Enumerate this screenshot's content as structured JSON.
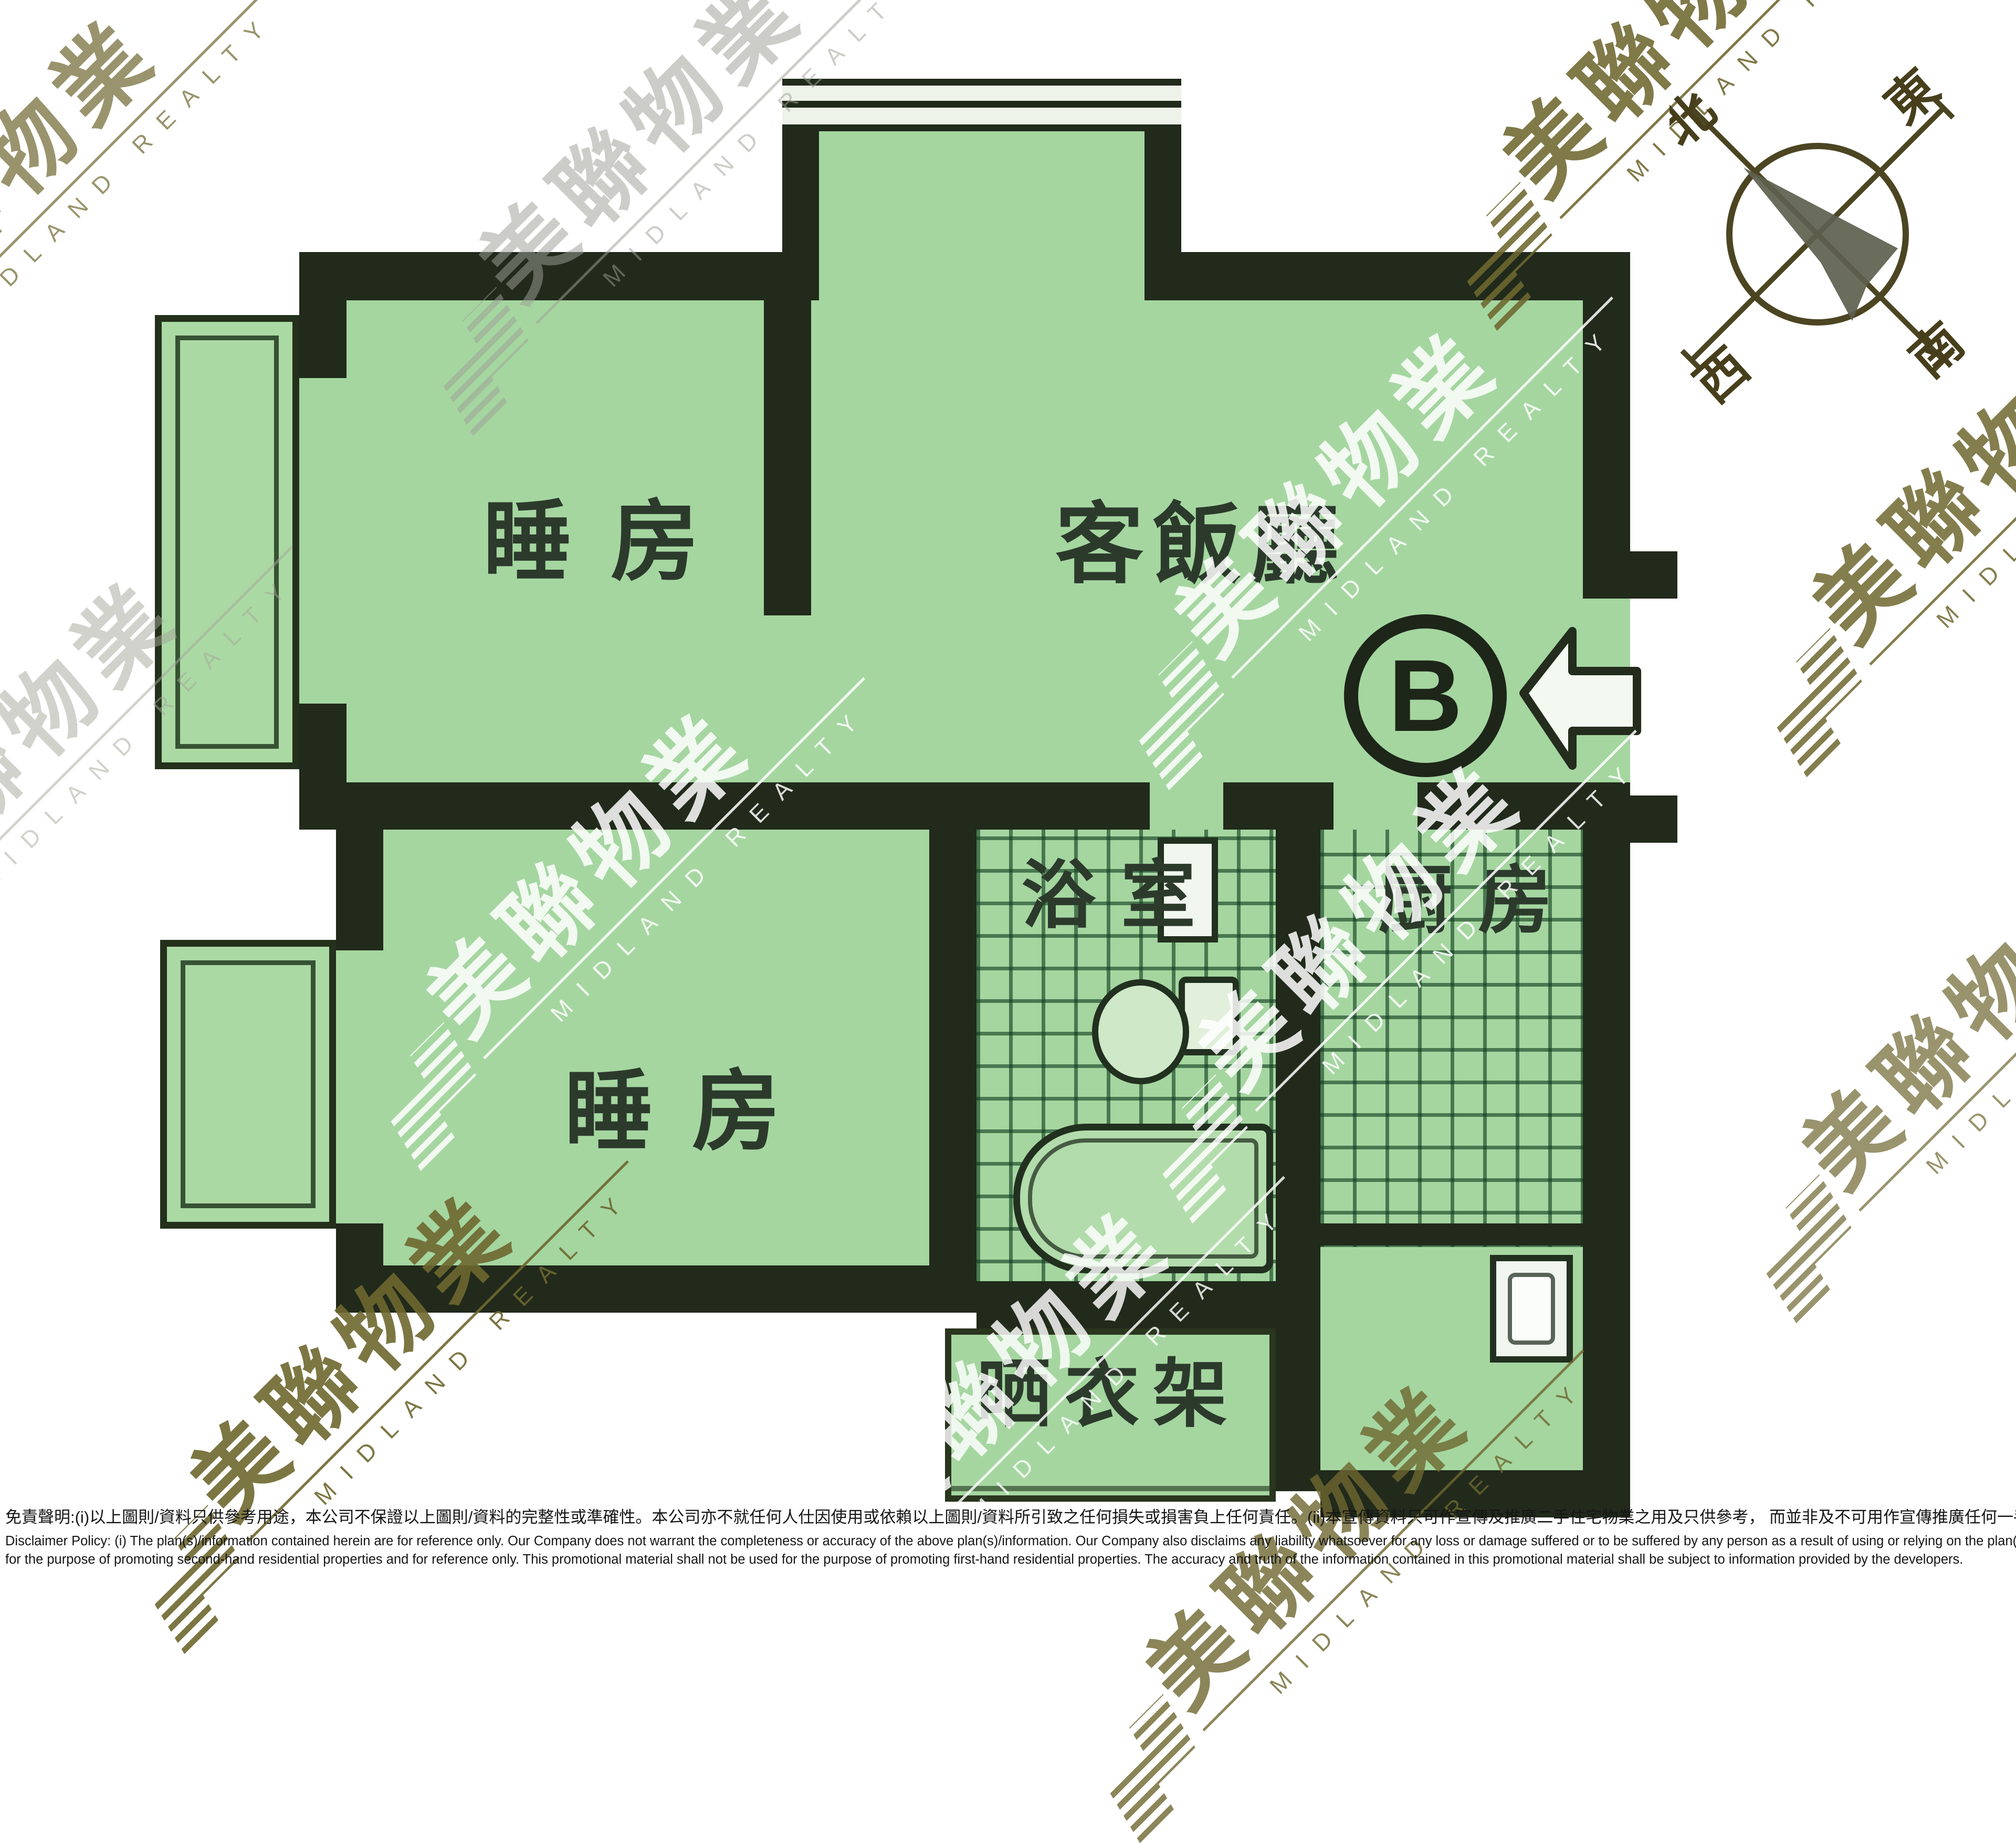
{
  "plan": {
    "unit_label": "B",
    "rooms": {
      "bedroom1": "睡房",
      "living_dining": "客飯廳",
      "bedroom2": "睡房",
      "bathroom": "浴室",
      "kitchen": "厨房",
      "drying_rack": "晒衣架"
    }
  },
  "compass": {
    "north": "北",
    "east": "東",
    "west": "西",
    "south": "南"
  },
  "watermark": {
    "cjk": "美聯物業",
    "latin": "MIDLAND REALTY"
  },
  "colors": {
    "room_green": "#a5d6a0",
    "wall_dark": "#212a1b",
    "watermark_olive": "#6e672f",
    "compass_stroke": "#4c4522",
    "label_green": "#2c3a2c"
  },
  "disclaimer": {
    "chinese": "免責聲明:(i)以上圖則/資料只供參考用途，本公司不保證以上圖則/資料的完整性或準確性。本公司亦不就任何人仕因使用或依賴以上圖則/資料所引致之任何損失或損害負上任何責任。(ii)本宣傳資料只可作宣傳及推廣二手住宅物業之用及只供參考， 而並非及不可用作宣傳推廣任何一手住宅物業，其準確性及真實性以樓盤發展商提供的資料為準。",
    "english_line1": "Disclaimer Policy: (i) The plan(s)/information contained herein are for reference only. Our Company does not warrant the completeness or accuracy of the above plan(s)/information. Our Company also disclaims any liability whatsoever for any loss or damage suffered or to be suffered by any person as a result of using or relying on the plan(s)/information. (ii) This promotional material is",
    "english_line2": "for the purpose of promoting second-hand residential properties and for reference only. This promotional material shall not be used for the purpose of promoting first-hand residential properties. The accuracy and truth of the information contained in this promotional material shall be subject to information provided by the developers."
  }
}
